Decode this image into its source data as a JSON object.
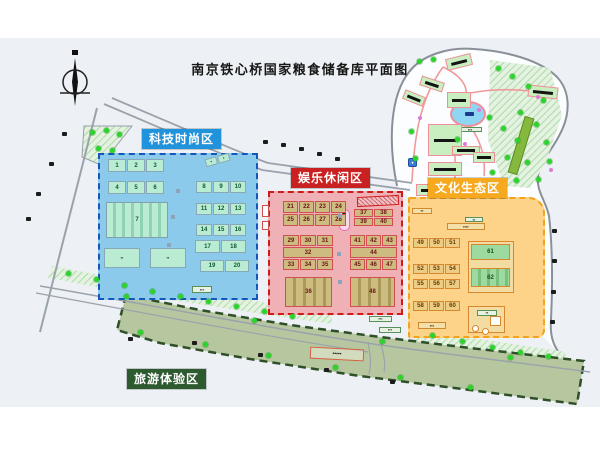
{
  "title": "南京铁心桥国家粮食储备库平面图",
  "zones": {
    "tech": {
      "label": "科技时尚区",
      "color": "#2193dd"
    },
    "ent": {
      "label": "娱乐休闲区",
      "color": "#c92121"
    },
    "cul": {
      "label": "文化生态区",
      "color": "#f6a91e"
    },
    "tour": {
      "label": "旅游体验区",
      "color": "#2e5a30"
    }
  },
  "building_groups": [
    {
      "zone": "tech",
      "style": "mint",
      "x": 108,
      "y": 159,
      "cw": 18,
      "ch": 13,
      "rows": [
        [
          "1",
          "2",
          "3"
        ]
      ]
    },
    {
      "zone": "tech",
      "style": "mint",
      "x": 108,
      "y": 181,
      "cw": 18,
      "ch": 13,
      "rows": [
        [
          "4",
          "5",
          "6"
        ]
      ]
    },
    {
      "zone": "tech",
      "style": "mintS",
      "x": 106,
      "y": 202,
      "cw": 62,
      "ch": 36,
      "rows": [
        [
          "7"
        ]
      ]
    },
    {
      "zone": "tech",
      "style": "mintD",
      "x": 104,
      "y": 248,
      "cw": 36,
      "ch": 20,
      "rows": [
        [
          "▪▪"
        ]
      ]
    },
    {
      "zone": "tech",
      "style": "mintD",
      "x": 150,
      "y": 248,
      "cw": 36,
      "ch": 20,
      "rows": [
        [
          "▪▪"
        ]
      ]
    },
    {
      "zone": "tech",
      "style": "mintD",
      "x": 205,
      "y": 156,
      "cw": 12,
      "ch": 8,
      "rot": -16,
      "rows": [
        [
          "▪",
          "▪"
        ]
      ]
    },
    {
      "zone": "tech",
      "style": "mint",
      "x": 196,
      "y": 181,
      "cw": 16,
      "ch": 12,
      "rows": [
        [
          "8",
          "9",
          "10"
        ]
      ]
    },
    {
      "zone": "tech",
      "style": "mint",
      "x": 196,
      "y": 203,
      "cw": 16,
      "ch": 12,
      "rows": [
        [
          "11",
          "12",
          "13"
        ]
      ]
    },
    {
      "zone": "tech",
      "style": "mint",
      "x": 196,
      "y": 224,
      "cw": 16,
      "ch": 12,
      "rows": [
        [
          "14",
          "15",
          "16"
        ]
      ]
    },
    {
      "zone": "tech",
      "style": "mint",
      "x": 195,
      "y": 240,
      "cw": 25,
      "ch": 13,
      "rows": [
        [
          "17",
          "18"
        ]
      ]
    },
    {
      "zone": "tech",
      "style": "mint",
      "x": 200,
      "y": 260,
      "cw": 24,
      "ch": 12,
      "rows": [
        [
          "19",
          "20"
        ]
      ]
    },
    {
      "zone": "ent",
      "style": "tan",
      "x": 283,
      "y": 201,
      "cw": 15,
      "ch": 12,
      "rows": [
        [
          "21",
          "22",
          "23",
          "24"
        ],
        [
          "25",
          "26",
          "27",
          "28"
        ]
      ]
    },
    {
      "zone": "ent",
      "style": "tan",
      "x": 354,
      "y": 209,
      "cw": 19,
      "ch": 8,
      "rows": [
        [
          "37",
          "38"
        ],
        [
          "39",
          "40"
        ]
      ]
    },
    {
      "zone": "ent",
      "style": "tan",
      "x": 283,
      "y": 235,
      "cw": 16,
      "ch": 11,
      "rows": [
        [
          "29",
          "30",
          "31"
        ],
        [
          "32"
        ],
        [
          "33",
          "34",
          "35"
        ]
      ]
    },
    {
      "zone": "ent",
      "style": "tan",
      "x": 350,
      "y": 235,
      "cw": 15,
      "ch": 11,
      "rows": [
        [
          "41",
          "42",
          "43"
        ],
        [
          "44"
        ],
        [
          "45",
          "46",
          "47"
        ]
      ]
    },
    {
      "zone": "ent",
      "style": "tanS",
      "x": 285,
      "y": 277,
      "cw": 47,
      "ch": 30,
      "rows": [
        [
          "36"
        ]
      ]
    },
    {
      "zone": "ent",
      "style": "tanS",
      "x": 350,
      "y": 277,
      "cw": 45,
      "ch": 30,
      "rows": [
        [
          "48"
        ]
      ]
    },
    {
      "zone": "cul",
      "style": "sand",
      "x": 413,
      "y": 238,
      "cw": 15,
      "ch": 10,
      "rows": [
        [
          "49",
          "50",
          "51"
        ]
      ]
    },
    {
      "zone": "cul",
      "style": "sand",
      "x": 413,
      "y": 264,
      "cw": 15,
      "ch": 10,
      "rows": [
        [
          "52",
          "53",
          "54"
        ]
      ]
    },
    {
      "zone": "cul",
      "style": "sand",
      "x": 413,
      "y": 279,
      "cw": 15,
      "ch": 10,
      "rows": [
        [
          "55",
          "56",
          "57"
        ]
      ]
    },
    {
      "zone": "cul",
      "style": "sand",
      "x": 413,
      "y": 301,
      "cw": 15,
      "ch": 10,
      "rows": [
        [
          "58",
          "59",
          "60"
        ]
      ]
    },
    {
      "zone": "cul",
      "style": "court",
      "x": 471,
      "y": 244,
      "cw": 39,
      "ch": 16,
      "rows": [
        [
          "61"
        ]
      ]
    },
    {
      "zone": "cul",
      "style": "courtS",
      "x": 471,
      "y": 268,
      "cw": 39,
      "ch": 19,
      "rows": [
        [
          "62"
        ]
      ]
    }
  ],
  "frames": [
    {
      "x": 468,
      "y": 241,
      "w": 46,
      "h": 52
    },
    {
      "x": 468,
      "y": 306,
      "w": 37,
      "h": 27
    }
  ],
  "chips": [
    {
      "x": 192,
      "y": 286,
      "w": 20,
      "h": 7,
      "style": "dark",
      "label": "▪▪▪"
    },
    {
      "x": 369,
      "y": 316,
      "w": 23,
      "h": 6,
      "style": "dark",
      "label": "▪▪▪"
    },
    {
      "x": 379,
      "y": 327,
      "w": 22,
      "h": 6,
      "style": "dark",
      "label": "▪▪▪"
    },
    {
      "x": 412,
      "y": 208,
      "w": 20,
      "h": 6,
      "style": "sand",
      "label": "▪▪"
    },
    {
      "x": 465,
      "y": 217,
      "w": 18,
      "h": 5,
      "style": "dark",
      "label": "▪▪"
    },
    {
      "x": 447,
      "y": 223,
      "w": 38,
      "h": 7,
      "style": "sand",
      "label": "▪▪▪▪"
    },
    {
      "x": 418,
      "y": 322,
      "w": 28,
      "h": 7,
      "style": "sand",
      "label": "▪▪▪"
    },
    {
      "x": 477,
      "y": 310,
      "w": 20,
      "h": 6,
      "style": "dark",
      "label": "▪▪"
    },
    {
      "x": 458,
      "y": 127,
      "w": 24,
      "h": 5,
      "style": "dark",
      "label": "▪▪▪"
    },
    {
      "x": 310,
      "y": 348,
      "w": 54,
      "h": 12,
      "style": "sign",
      "rot": 3,
      "label": "▪▪▪▪▪"
    },
    {
      "x": 262,
      "y": 205,
      "w": 7,
      "h": 12,
      "style": "wr",
      "label": ""
    },
    {
      "x": 262,
      "y": 221,
      "w": 7,
      "h": 9,
      "style": "wr",
      "label": ""
    },
    {
      "x": 472,
      "y": 325,
      "w": 7,
      "h": 7,
      "style": "wsr",
      "label": ""
    },
    {
      "x": 482,
      "y": 328,
      "w": 7,
      "h": 7,
      "style": "wsr",
      "label": ""
    },
    {
      "x": 490,
      "y": 316,
      "w": 11,
      "h": 10,
      "style": "ws",
      "label": ""
    },
    {
      "x": 408,
      "y": 158,
      "w": 9,
      "h": 9,
      "style": "blue",
      "label": "▾"
    }
  ],
  "park_buildings": [
    {
      "x": 446,
      "y": 56,
      "w": 26,
      "h": 12,
      "rot": -14
    },
    {
      "x": 420,
      "y": 79,
      "w": 24,
      "h": 10,
      "rot": 18
    },
    {
      "x": 403,
      "y": 93,
      "w": 22,
      "h": 10,
      "rot": 22
    },
    {
      "x": 447,
      "y": 92,
      "w": 24,
      "h": 16,
      "rot": 0
    },
    {
      "x": 528,
      "y": 86,
      "w": 30,
      "h": 12,
      "rot": 6
    },
    {
      "x": 428,
      "y": 124,
      "w": 34,
      "h": 32,
      "rot": 0
    },
    {
      "x": 428,
      "y": 162,
      "w": 34,
      "h": 14,
      "rot": 0
    },
    {
      "x": 416,
      "y": 184,
      "w": 30,
      "h": 12,
      "rot": 0
    },
    {
      "x": 452,
      "y": 146,
      "w": 28,
      "h": 9,
      "rot": 0
    },
    {
      "x": 473,
      "y": 152,
      "w": 22,
      "h": 11,
      "rot": 0
    }
  ],
  "trees": [
    [
      498,
      68
    ],
    [
      512,
      76
    ],
    [
      528,
      86
    ],
    [
      543,
      100
    ],
    [
      520,
      112
    ],
    [
      536,
      124
    ],
    [
      503,
      128
    ],
    [
      517,
      140
    ],
    [
      546,
      142
    ],
    [
      507,
      157
    ],
    [
      527,
      162
    ],
    [
      549,
      161
    ],
    [
      492,
      172
    ],
    [
      516,
      180
    ],
    [
      538,
      179
    ],
    [
      419,
      61
    ],
    [
      433,
      59
    ],
    [
      411,
      131
    ],
    [
      415,
      158
    ],
    [
      489,
      117
    ],
    [
      457,
      139
    ],
    [
      68,
      273
    ],
    [
      96,
      279
    ],
    [
      124,
      285
    ],
    [
      152,
      291
    ],
    [
      180,
      296
    ],
    [
      208,
      301
    ],
    [
      236,
      306
    ],
    [
      264,
      311
    ],
    [
      292,
      316
    ],
    [
      432,
      335
    ],
    [
      462,
      341
    ],
    [
      492,
      347
    ],
    [
      520,
      352
    ],
    [
      548,
      356
    ],
    [
      92,
      132
    ],
    [
      106,
      130
    ],
    [
      119,
      134
    ],
    [
      98,
      148
    ],
    [
      112,
      150
    ],
    [
      140,
      332
    ],
    [
      205,
      344
    ],
    [
      268,
      355
    ],
    [
      335,
      367
    ],
    [
      400,
      377
    ],
    [
      470,
      387
    ],
    [
      126,
      296
    ],
    [
      254,
      320
    ],
    [
      382,
      341
    ],
    [
      510,
      357
    ]
  ],
  "flowers": [
    [
      536,
      95
    ],
    [
      549,
      168
    ],
    [
      493,
      183
    ],
    [
      477,
      108
    ],
    [
      463,
      142
    ],
    [
      418,
      116
    ]
  ],
  "glyphs": [
    [
      62,
      132
    ],
    [
      49,
      162
    ],
    [
      36,
      192
    ],
    [
      26,
      217
    ],
    [
      263,
      140
    ],
    [
      281,
      143
    ],
    [
      299,
      147
    ],
    [
      317,
      152
    ],
    [
      335,
      157
    ],
    [
      552,
      229
    ],
    [
      552,
      259
    ],
    [
      551,
      290
    ],
    [
      550,
      320
    ],
    [
      128,
      337
    ],
    [
      192,
      341
    ],
    [
      258,
      353
    ],
    [
      324,
      368
    ],
    [
      390,
      380
    ]
  ],
  "spine_marks": [
    [
      176,
      189
    ],
    [
      171,
      215
    ],
    [
      167,
      243
    ],
    [
      338,
      214
    ],
    [
      337,
      252
    ],
    [
      338,
      280
    ]
  ]
}
